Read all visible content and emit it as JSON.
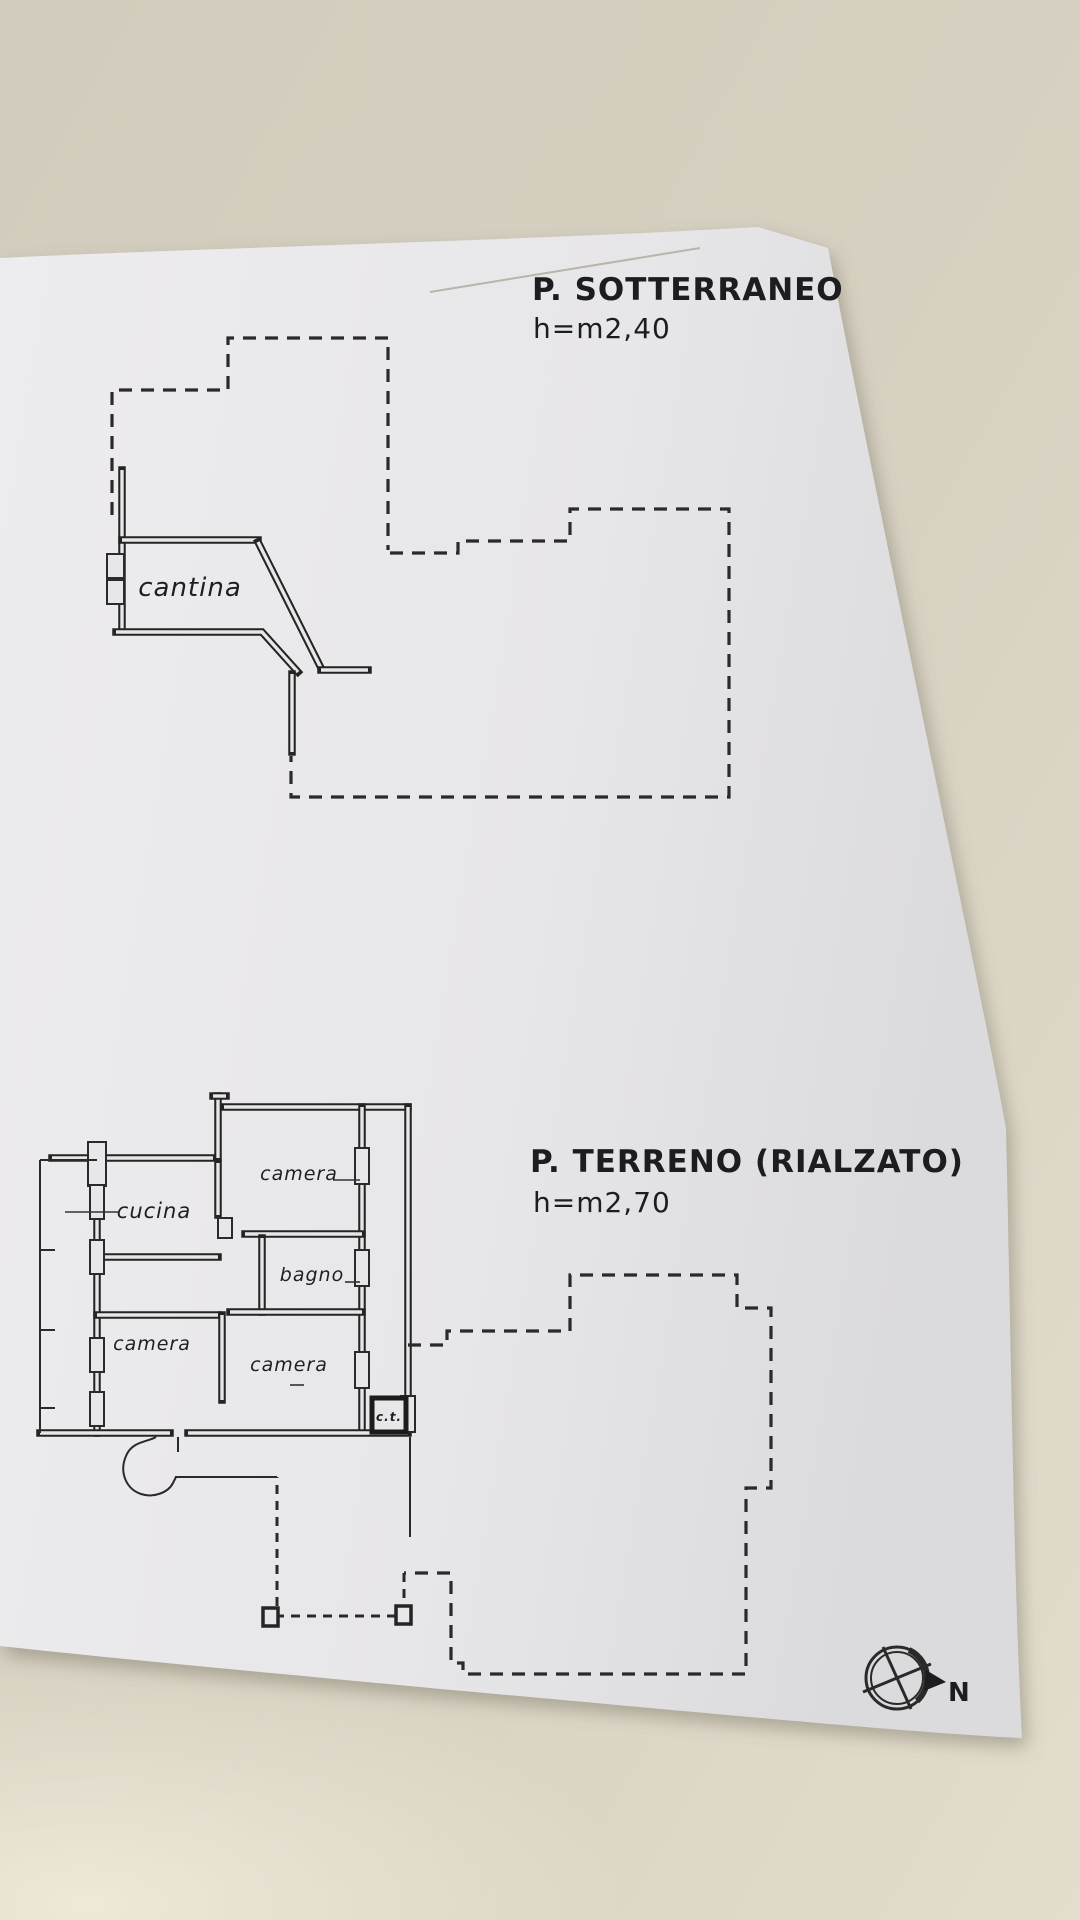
{
  "document": {
    "basement": {
      "title": "P. SOTTERRANEO",
      "height_note": "h=m2,40",
      "room_cantina": "cantina"
    },
    "ground": {
      "title": "P. TERRENO (RIALZATO)",
      "height_note": "h=m2,70",
      "room_camera_top": "camera",
      "room_cucina": "cucina",
      "room_bagno": "bagno",
      "room_camera_left": "camera",
      "room_camera_mid": "camera",
      "room_ct": "c.t."
    },
    "compass": {
      "north_label": "N"
    },
    "colors": {
      "paper": "#e7e6e8",
      "table": "#d5cfc0",
      "ink": "#2a2a2a"
    }
  }
}
